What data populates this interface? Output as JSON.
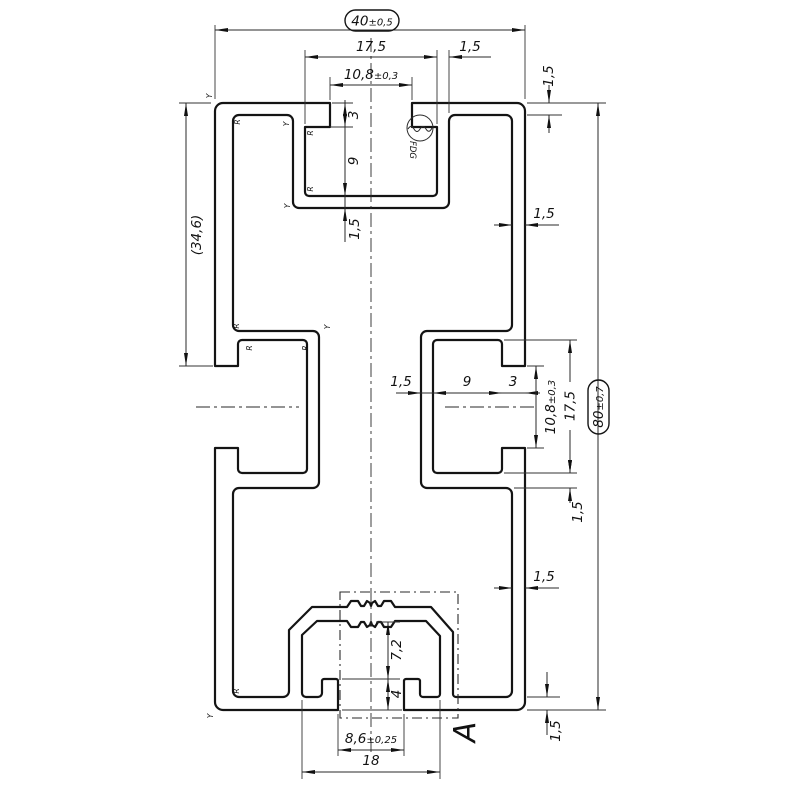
{
  "dims": {
    "overall_width": {
      "value": "40",
      "tol": "±0,5"
    },
    "overall_height": {
      "value": "80",
      "tol": "±0,7"
    },
    "slot_cavity": "17,5",
    "slot_mouth": {
      "value": "10,8",
      "tol": "±0,3"
    },
    "wall": "1,5",
    "slot_depth": "9",
    "lip_depth": "3",
    "ref_left": "(34,6)",
    "bottom_mouth": {
      "value": "8,6",
      "tol": "±0,25"
    },
    "bottom_cavity_width": "18",
    "bottom_port_depth": "7,2",
    "bottom_hook_height": "4"
  },
  "labels": {
    "detail": "A",
    "fdg_marker": "FDG",
    "radius_marker": "R",
    "y_marker": "Y"
  }
}
